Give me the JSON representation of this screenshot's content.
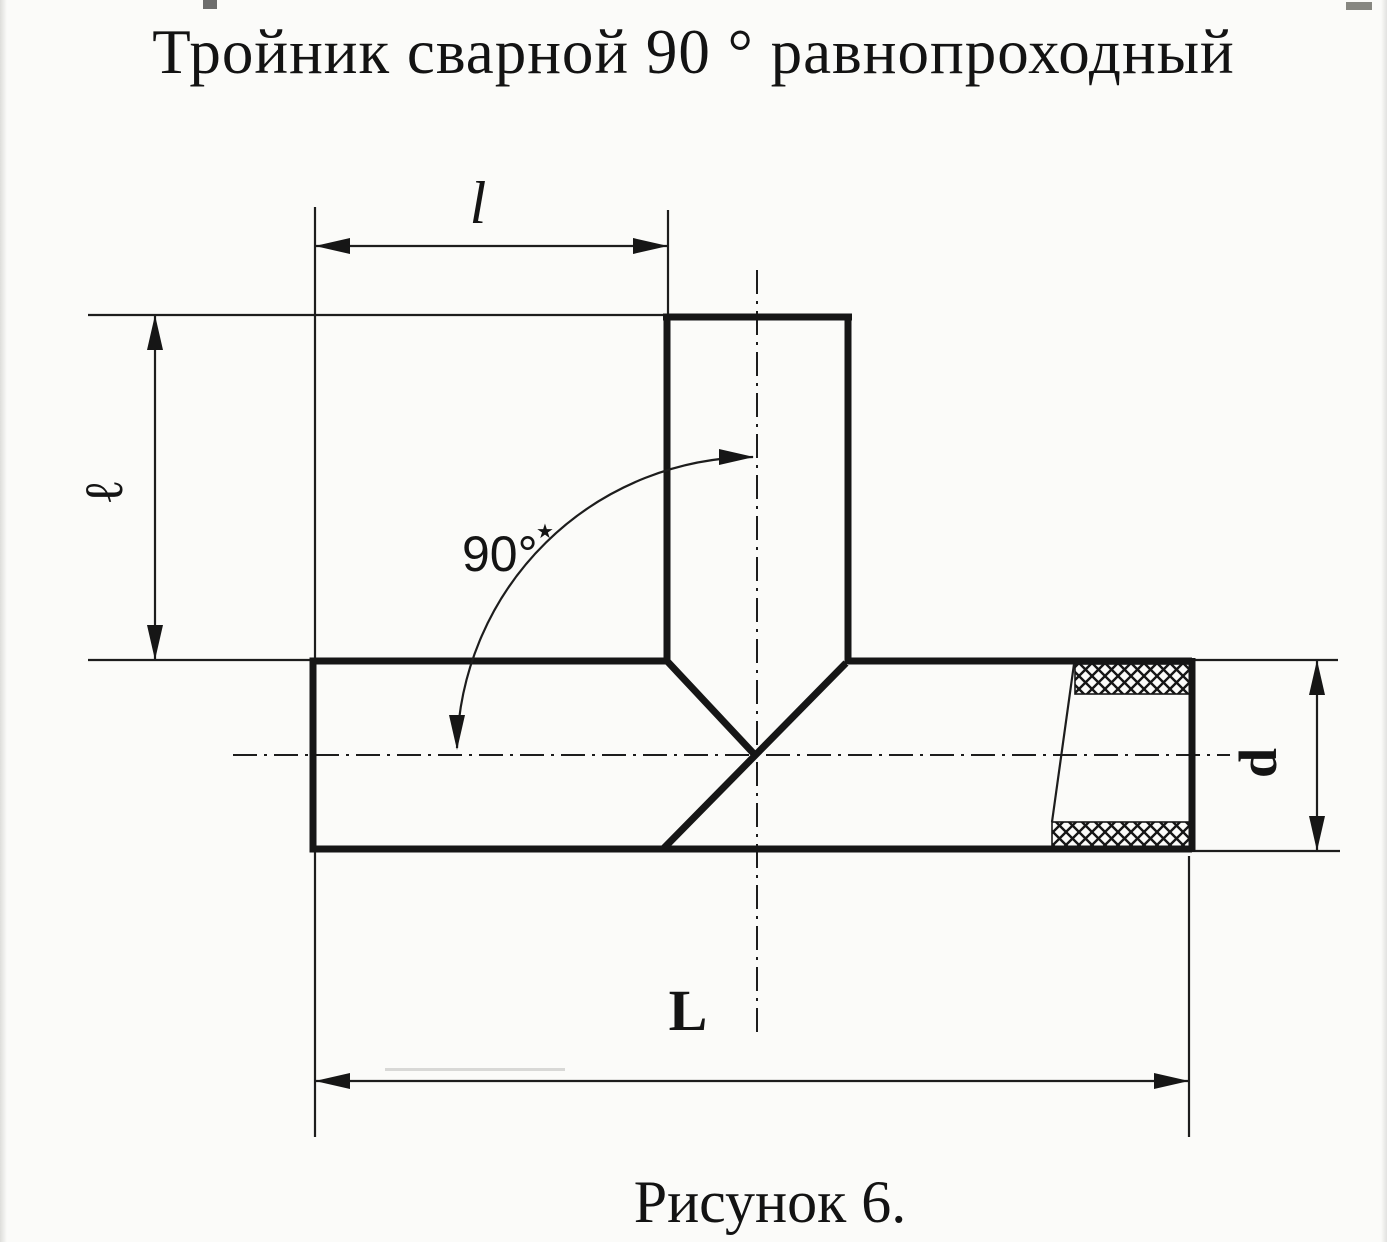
{
  "title": "Тройник сварной 90 ° равнопроходный",
  "caption": "Рисунок 6.",
  "labels": {
    "branch_length": "l",
    "branch_height": "ℓ",
    "angle": "90°",
    "angle_footnote": "★",
    "overall_length": "L",
    "diameter": "d"
  },
  "colors": {
    "ink": "#161616",
    "paper": "#fbfbf9"
  }
}
